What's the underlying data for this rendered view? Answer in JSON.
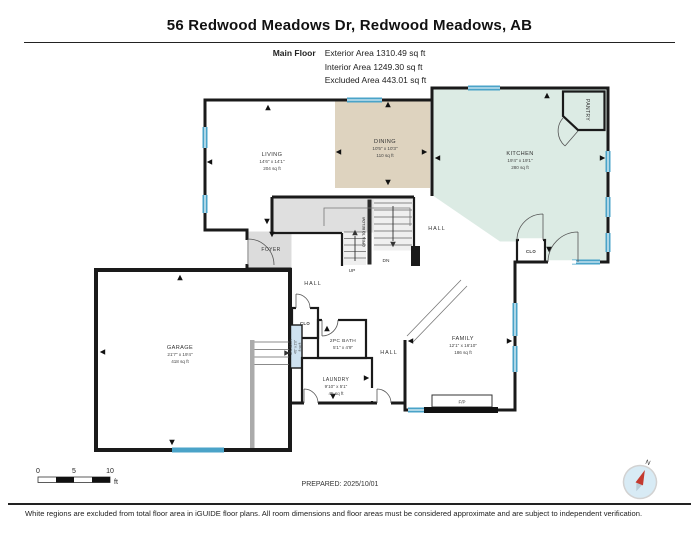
{
  "header": {
    "title": "56 Redwood Meadows Dr, Redwood Meadows, AB",
    "floor_label": "Main Floor",
    "areas": [
      "Exterior Area 1310.49 sq ft",
      "Interior Area 1249.30 sq ft",
      "Excluded Area 443.01 sq ft"
    ]
  },
  "rooms": {
    "living": {
      "name": "LIVING",
      "dims": "14'6\" x 14'1\"",
      "area": "204 sq ft"
    },
    "dining": {
      "name": "DINING",
      "dims": "10'5\" x 10'3\"",
      "area": "110 sq ft"
    },
    "kitchen": {
      "name": "KITCHEN",
      "dims": "19'4\" x 19'1\"",
      "area": "280 sq ft"
    },
    "family": {
      "name": "FAMILY",
      "dims": "12'1\" x 16'10\"",
      "area": "186 sq ft"
    },
    "garage": {
      "name": "GARAGE",
      "dims": "21'7\" x 19'4\"",
      "area": "418 sq ft"
    },
    "laundry": {
      "name": "LAUNDRY",
      "dims": "9'10\" x 5'1\"",
      "area": "45 sq ft"
    },
    "bath": {
      "name": "2PC BATH",
      "dims": "5'1\" x 4'9\""
    },
    "bath_strip": {
      "name": "2PC BATH",
      "dims": "4'0\" x 2'0\"",
      "area": "8 sq ft"
    },
    "pantry": {
      "name": "PANTRY"
    },
    "foyer": {
      "name": "FOYER"
    },
    "closet": {
      "name": "CLO"
    },
    "hall": {
      "name": "HALL"
    },
    "stairs": {
      "up": "UP",
      "down": "DN",
      "open": "OPEN TO BELOW"
    },
    "fireplace": {
      "name": "F/P"
    }
  },
  "scale_bar": {
    "ticks": [
      "0",
      "5",
      "10"
    ],
    "unit": "ft"
  },
  "prepared": "PREPARED: 2025/10/01",
  "compass": {
    "north_label": "N"
  },
  "disclaimer": "White regions are excluded from total floor area in iGUIDE floor plans. All room dimensions and floor areas must be considered approximate and are subject to independent verification.",
  "colors": {
    "wall": "#1a1a1a",
    "window": "#4aa3c8",
    "floor_yellow": "#faf3da",
    "tan": "#ded3bf",
    "kitchen_mint": "#dcebe4",
    "bath_blue": "#cfe2f0",
    "gray": "#dcdcdc",
    "garage_white": "#ffffff",
    "compass_blue": "#d8ebf5",
    "compass_red": "#c43a2f"
  }
}
